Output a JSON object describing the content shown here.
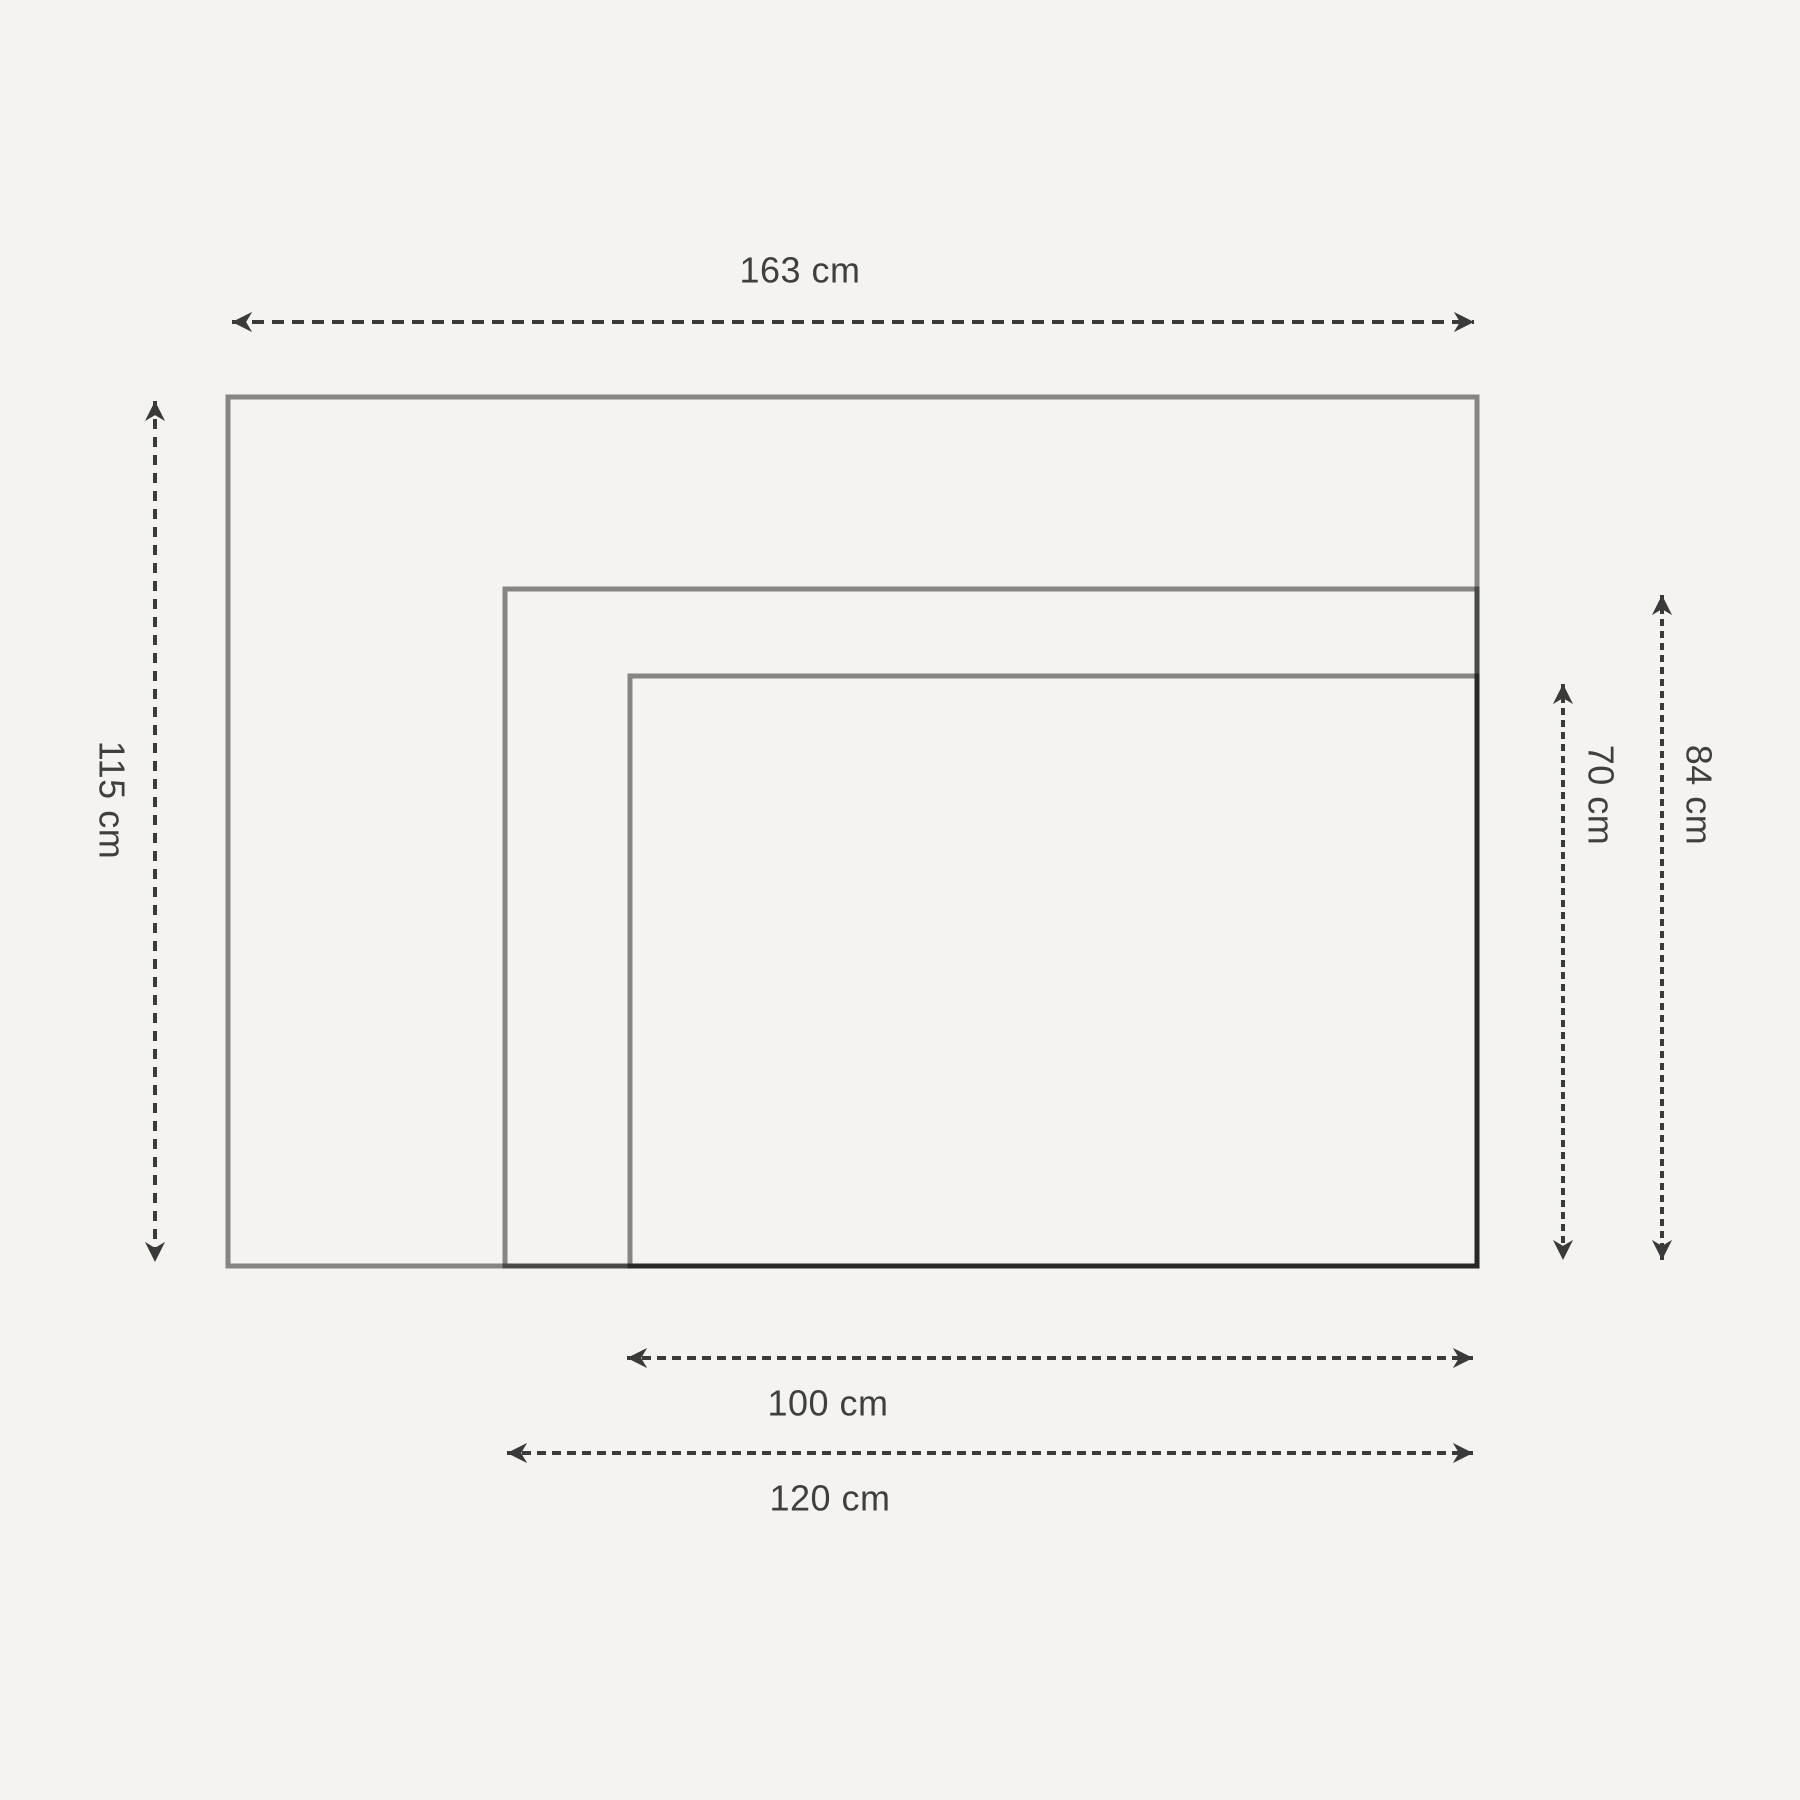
{
  "figure": {
    "kind": "nested-rectangles-dimension-diagram",
    "unit": "cm",
    "colors": {
      "background": "#f4f3f0",
      "rectangle_stroke": "rgba(0,0,0,0.45)",
      "dimension_stroke": "#3a3a3a",
      "label_text": "#3f3f3f"
    },
    "sizes": [
      {
        "id": "large",
        "width_cm": 163,
        "height_cm": 115,
        "width_label": "163 cm",
        "height_label": "115 cm"
      },
      {
        "id": "medium",
        "width_cm": 120,
        "height_cm": 84,
        "width_label": "120 cm",
        "height_label": "84 cm"
      },
      {
        "id": "small",
        "width_cm": 100,
        "height_cm": 70,
        "width_label": "100 cm",
        "height_label": "70 cm"
      }
    ]
  }
}
